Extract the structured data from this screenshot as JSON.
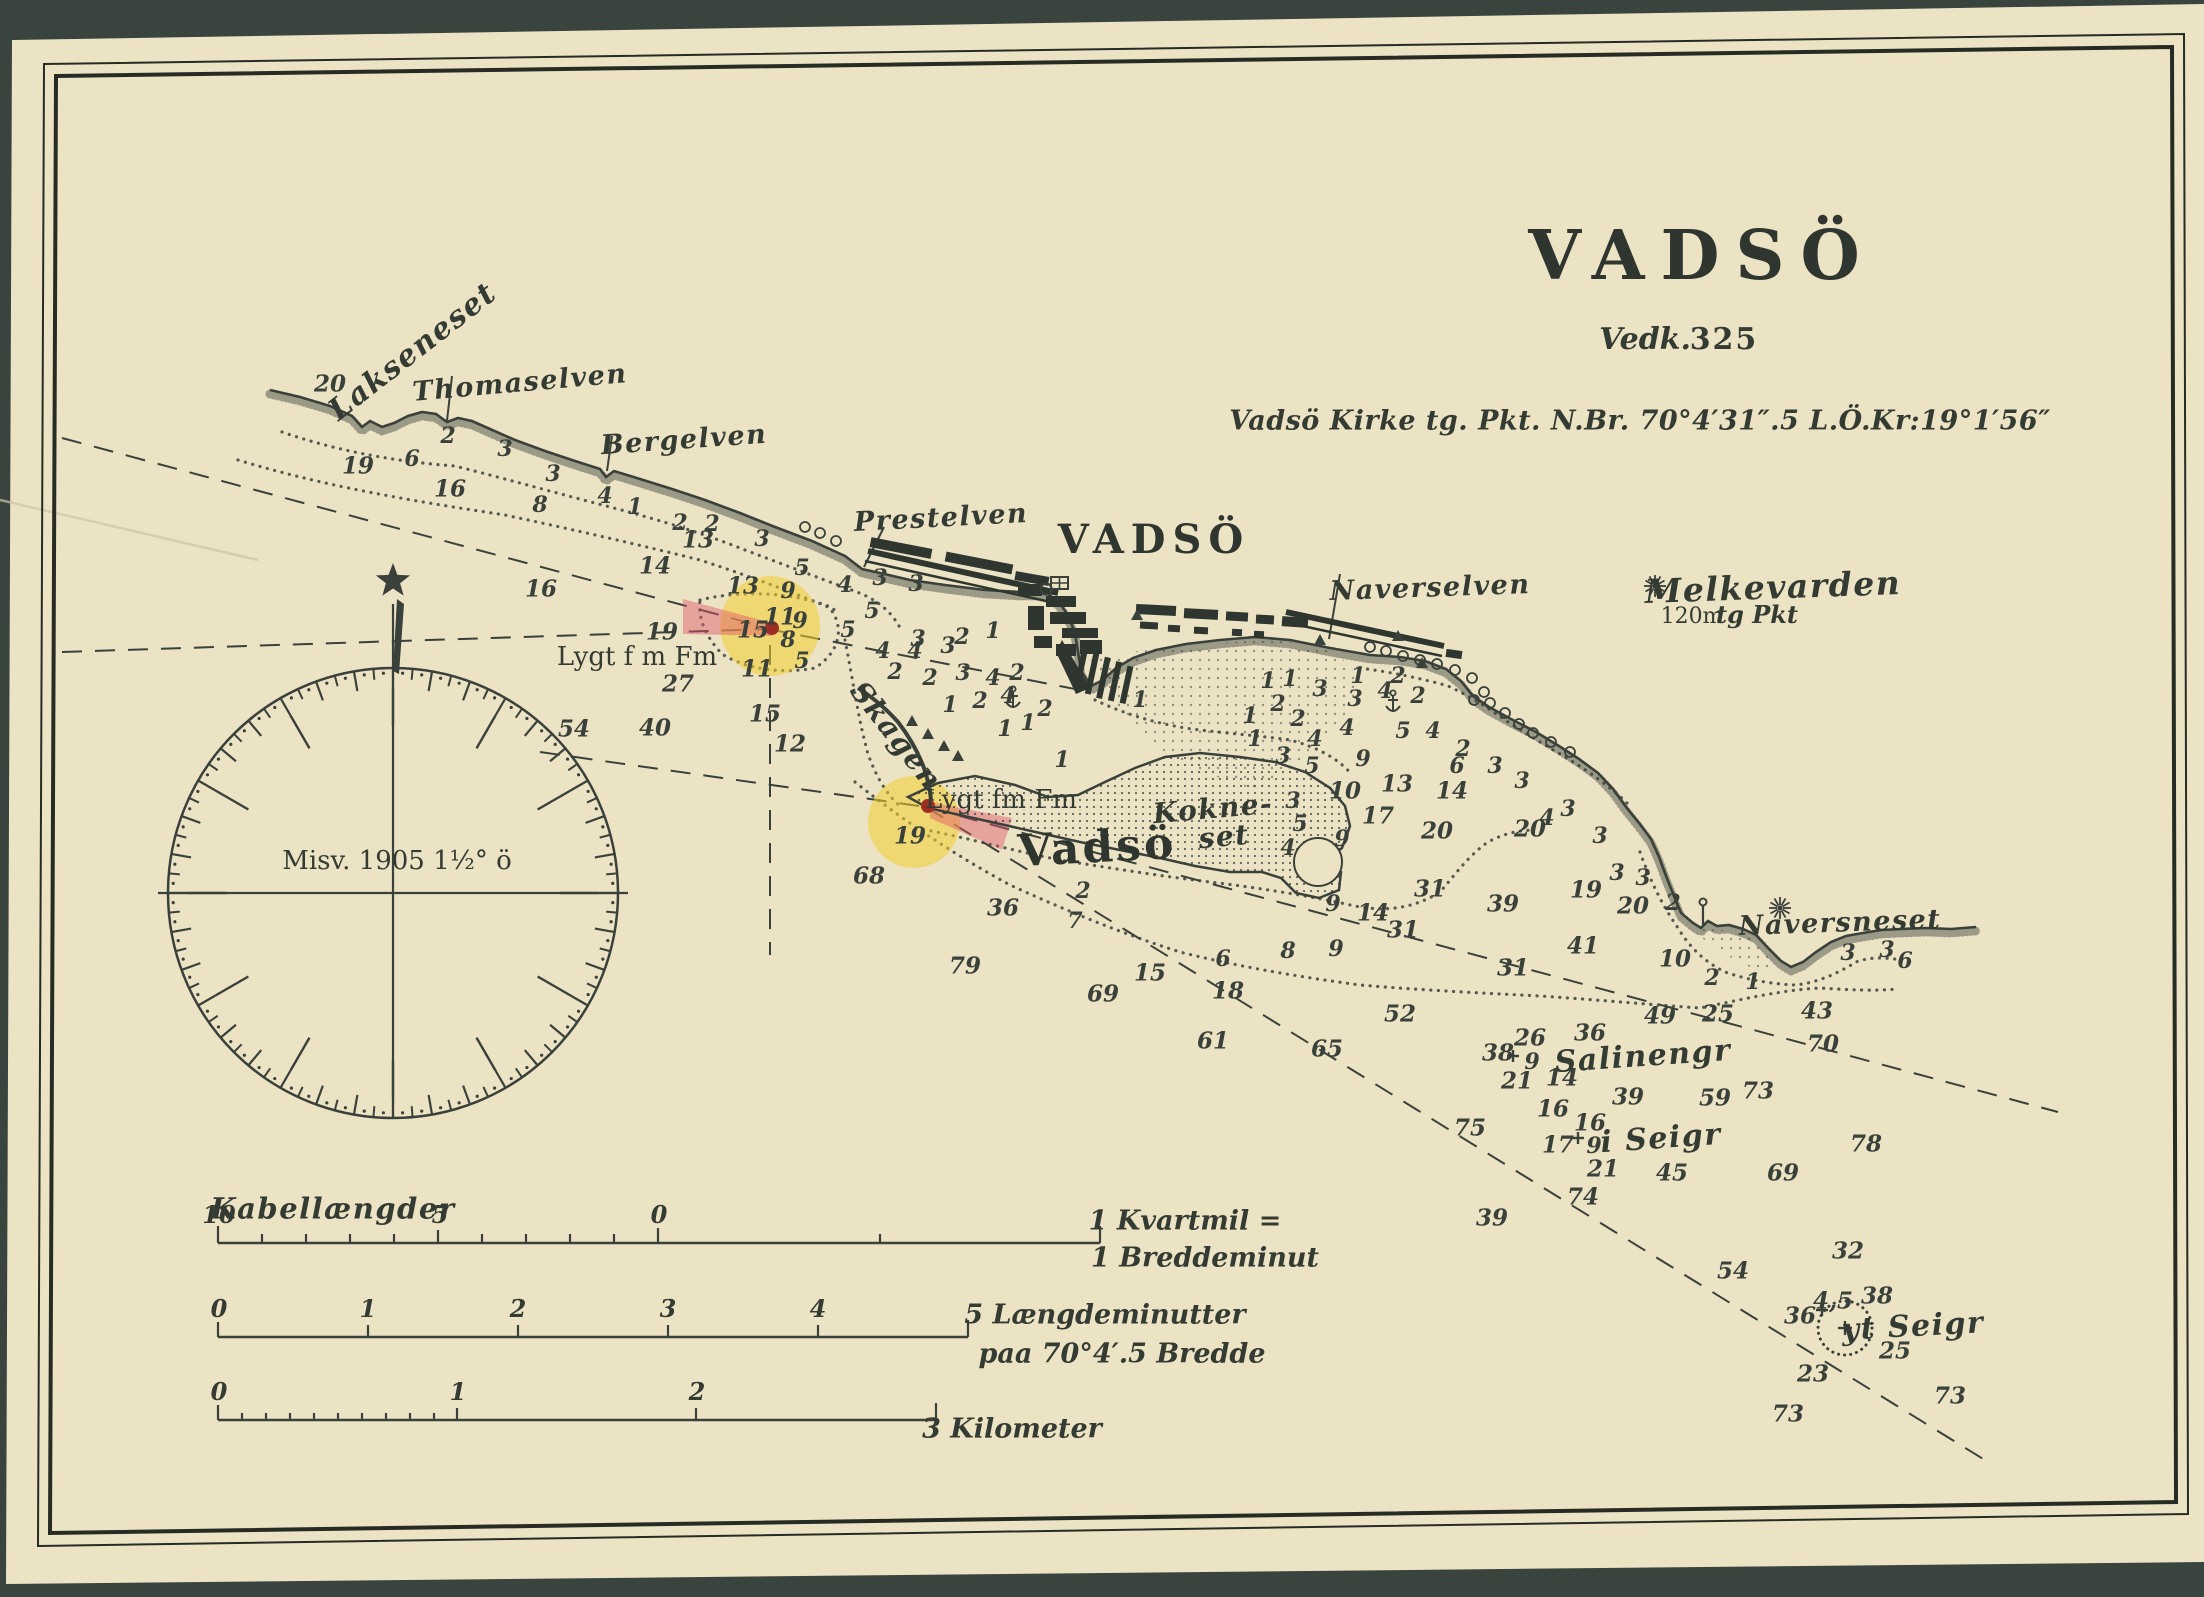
{
  "header": {
    "title": "VADSÖ",
    "vedk_label": "Vedk.",
    "vedk_number": "325",
    "position_line": "Vadsö Kirke tg. Pkt. N.Br. 70°4′31″.5 L.Ö.Kr:19°1′56″"
  },
  "compass": {
    "declination": "Misv. 1905 1½° ö"
  },
  "scales": {
    "bar1": {
      "name": "Kabellængder",
      "numbers": [
        {
          "t": "10",
          "x": 219
        },
        {
          "t": "5",
          "x": 440
        },
        {
          "t": "0",
          "x": 659
        }
      ],
      "right_label_1": "1 Kvartmil =",
      "right_label_2": "1 Breddeminut"
    },
    "bar2": {
      "numbers": [
        {
          "t": "0",
          "x": 219
        },
        {
          "t": "1",
          "x": 368
        },
        {
          "t": "2",
          "x": 518
        },
        {
          "t": "3",
          "x": 668
        },
        {
          "t": "4",
          "x": 818
        }
      ],
      "right_label_1": "5 Længdeminutter",
      "right_label_2": "paa 70°4′.5 Bredde"
    },
    "bar3": {
      "numbers": [
        {
          "t": "0",
          "x": 219
        },
        {
          "t": "1",
          "x": 458
        },
        {
          "t": "2",
          "x": 697
        }
      ],
      "right_label_1": "3 Kilometer",
      "right_label_2": ""
    }
  },
  "labels": [
    {
      "t": "Lakseneset",
      "x": 413,
      "y": 352,
      "s": 30,
      "r": -38,
      "c": "script"
    },
    {
      "t": "Thomaselven",
      "x": 520,
      "y": 383,
      "s": 27,
      "r": -5,
      "c": "script"
    },
    {
      "t": "Bergelven",
      "x": 684,
      "y": 440,
      "s": 27,
      "r": -4,
      "c": "script"
    },
    {
      "t": "Prestelven",
      "x": 941,
      "y": 518,
      "s": 27,
      "r": -3,
      "c": "script"
    },
    {
      "t": "VADSÖ",
      "x": 1154,
      "y": 540,
      "s": 40,
      "ls": 7,
      "c": "town"
    },
    {
      "t": "Naverselven",
      "x": 1430,
      "y": 588,
      "s": 27,
      "r": -2,
      "c": "script"
    },
    {
      "t": "Melkevarden",
      "x": 1773,
      "y": 587,
      "s": 33,
      "r": -2,
      "c": "script"
    },
    {
      "t": "120m",
      "x": 1692,
      "y": 617,
      "s": 22,
      "c": "plain"
    },
    {
      "t": "tg Pkt",
      "x": 1757,
      "y": 615,
      "s": 24,
      "c": "scalelbl"
    },
    {
      "t": "Skagen",
      "x": 896,
      "y": 736,
      "s": 29,
      "r": 52,
      "c": "script"
    },
    {
      "t": "Lygt f m Fm",
      "x": 637,
      "y": 657,
      "s": 26,
      "c": "plain"
    },
    {
      "t": "Lygt fm Fm",
      "x": 1001,
      "y": 800,
      "s": 26,
      "c": "plain"
    },
    {
      "t": "Vadsö",
      "x": 1097,
      "y": 848,
      "s": 44,
      "ls": 3,
      "r": -3,
      "c": "town"
    },
    {
      "t": "Kokne-",
      "x": 1213,
      "y": 809,
      "s": 28,
      "r": -5,
      "c": "script"
    },
    {
      "t": "set",
      "x": 1224,
      "y": 837,
      "s": 28,
      "r": -5,
      "c": "script"
    },
    {
      "t": "Naversneset",
      "x": 1840,
      "y": 923,
      "s": 27,
      "r": -2,
      "c": "script"
    },
    {
      "t": "Salinengr",
      "x": 1643,
      "y": 1057,
      "s": 30,
      "r": -4,
      "c": "script"
    },
    {
      "t": "i Seigr",
      "x": 1661,
      "y": 1139,
      "s": 30,
      "r": -4,
      "c": "script"
    },
    {
      "t": "yt Seigr",
      "x": 1913,
      "y": 1327,
      "s": 30,
      "r": -3,
      "c": "script"
    },
    {
      "t": "Kabellængder",
      "x": 333,
      "y": 1209,
      "s": 29,
      "c": "script"
    }
  ],
  "soundings": [
    [
      330,
      384,
      "20"
    ],
    [
      358,
      466,
      "19"
    ],
    [
      412,
      459,
      "6"
    ],
    [
      448,
      436,
      "2"
    ],
    [
      505,
      449,
      "3"
    ],
    [
      450,
      489,
      "16"
    ],
    [
      553,
      474,
      "3"
    ],
    [
      540,
      505,
      "8"
    ],
    [
      605,
      496,
      "4"
    ],
    [
      635,
      507,
      "1"
    ],
    [
      680,
      523,
      "2"
    ],
    [
      712,
      524,
      "2"
    ],
    [
      698,
      540,
      "13"
    ],
    [
      762,
      539,
      "3"
    ],
    [
      655,
      566,
      "14"
    ],
    [
      541,
      589,
      "16"
    ],
    [
      743,
      586,
      "13"
    ],
    [
      802,
      568,
      "5"
    ],
    [
      788,
      591,
      "9"
    ],
    [
      845,
      585,
      "4"
    ],
    [
      880,
      578,
      "3"
    ],
    [
      916,
      584,
      "3"
    ],
    [
      848,
      630,
      "5"
    ],
    [
      872,
      611,
      "5"
    ],
    [
      780,
      617,
      "11"
    ],
    [
      800,
      621,
      "9"
    ],
    [
      753,
      630,
      "15"
    ],
    [
      788,
      640,
      "8"
    ],
    [
      662,
      632,
      "19"
    ],
    [
      678,
      684,
      "27"
    ],
    [
      757,
      669,
      "11"
    ],
    [
      802,
      661,
      "5"
    ],
    [
      883,
      651,
      "4"
    ],
    [
      915,
      651,
      "4"
    ],
    [
      948,
      646,
      "3"
    ],
    [
      918,
      639,
      "3"
    ],
    [
      962,
      637,
      "2"
    ],
    [
      993,
      631,
      "1"
    ],
    [
      930,
      678,
      "2"
    ],
    [
      963,
      673,
      "3"
    ],
    [
      993,
      678,
      "4"
    ],
    [
      1017,
      673,
      "2"
    ],
    [
      895,
      672,
      "2"
    ],
    [
      950,
      705,
      "1"
    ],
    [
      980,
      701,
      "2"
    ],
    [
      1008,
      696,
      "4"
    ],
    [
      1045,
      709,
      "2"
    ],
    [
      1005,
      729,
      "1"
    ],
    [
      1028,
      723,
      "1"
    ],
    [
      1062,
      760,
      "1"
    ],
    [
      1140,
      700,
      "1"
    ],
    [
      765,
      714,
      "15"
    ],
    [
      790,
      744,
      "12"
    ],
    [
      655,
      728,
      "40"
    ],
    [
      574,
      729,
      "54"
    ],
    [
      910,
      836,
      "19"
    ],
    [
      869,
      876,
      "68"
    ],
    [
      1003,
      908,
      "36"
    ],
    [
      1083,
      891,
      "2"
    ],
    [
      1075,
      921,
      "7"
    ],
    [
      965,
      966,
      "79"
    ],
    [
      1150,
      973,
      "15"
    ],
    [
      1103,
      994,
      "69"
    ],
    [
      1223,
      959,
      "6"
    ],
    [
      1288,
      951,
      "8"
    ],
    [
      1336,
      949,
      "9"
    ],
    [
      1373,
      913,
      "14"
    ],
    [
      1403,
      930,
      "31"
    ],
    [
      1513,
      968,
      "31"
    ],
    [
      1583,
      946,
      "41"
    ],
    [
      1228,
      991,
      "18"
    ],
    [
      1213,
      1041,
      "61"
    ],
    [
      1327,
      1049,
      "65"
    ],
    [
      1400,
      1014,
      "52"
    ],
    [
      1470,
      1128,
      "75"
    ],
    [
      1268,
      681,
      "1"
    ],
    [
      1290,
      679,
      "1"
    ],
    [
      1320,
      689,
      "3"
    ],
    [
      1355,
      699,
      "3"
    ],
    [
      1358,
      676,
      "1"
    ],
    [
      1385,
      691,
      "4"
    ],
    [
      1398,
      676,
      "2"
    ],
    [
      1418,
      696,
      "2"
    ],
    [
      1278,
      704,
      "2"
    ],
    [
      1250,
      716,
      "1"
    ],
    [
      1298,
      719,
      "2"
    ],
    [
      1255,
      739,
      "1"
    ],
    [
      1283,
      756,
      "3"
    ],
    [
      1315,
      739,
      "4"
    ],
    [
      1347,
      728,
      "4"
    ],
    [
      1312,
      766,
      "5"
    ],
    [
      1403,
      731,
      "5"
    ],
    [
      1433,
      731,
      "4"
    ],
    [
      1363,
      759,
      "9"
    ],
    [
      1463,
      749,
      "2"
    ],
    [
      1457,
      766,
      "6"
    ],
    [
      1495,
      766,
      "3"
    ],
    [
      1522,
      781,
      "3"
    ],
    [
      1345,
      791,
      "10"
    ],
    [
      1397,
      784,
      "13"
    ],
    [
      1452,
      791,
      "14"
    ],
    [
      1378,
      816,
      "17"
    ],
    [
      1437,
      831,
      "20"
    ],
    [
      1530,
      829,
      "20"
    ],
    [
      1547,
      818,
      "4"
    ],
    [
      1342,
      839,
      "9"
    ],
    [
      1293,
      801,
      "3"
    ],
    [
      1300,
      824,
      "5"
    ],
    [
      1288,
      848,
      "4"
    ],
    [
      1430,
      889,
      "31"
    ],
    [
      1503,
      904,
      "39"
    ],
    [
      1333,
      904,
      "9"
    ],
    [
      1568,
      809,
      "3"
    ],
    [
      1600,
      836,
      "3"
    ],
    [
      1586,
      890,
      "19"
    ],
    [
      1617,
      873,
      "3"
    ],
    [
      1643,
      878,
      "3"
    ],
    [
      1633,
      906,
      "20"
    ],
    [
      1675,
      959,
      "10"
    ],
    [
      1673,
      903,
      "2"
    ],
    [
      1712,
      978,
      "2"
    ],
    [
      1753,
      982,
      "1"
    ],
    [
      1848,
      953,
      "3"
    ],
    [
      1887,
      950,
      "3"
    ],
    [
      1905,
      961,
      "6"
    ],
    [
      1660,
      1016,
      "49"
    ],
    [
      1718,
      1014,
      "25"
    ],
    [
      1817,
      1011,
      "43"
    ],
    [
      1823,
      1044,
      "70"
    ],
    [
      1530,
      1038,
      "26"
    ],
    [
      1498,
      1053,
      "38"
    ],
    [
      1532,
      1062,
      "9"
    ],
    [
      1517,
      1081,
      "21"
    ],
    [
      1562,
      1078,
      "14"
    ],
    [
      1590,
      1033,
      "36"
    ],
    [
      1628,
      1097,
      "39"
    ],
    [
      1715,
      1098,
      "59"
    ],
    [
      1758,
      1091,
      "73"
    ],
    [
      1553,
      1109,
      "16"
    ],
    [
      1590,
      1123,
      "16"
    ],
    [
      1558,
      1145,
      "17"
    ],
    [
      1594,
      1146,
      "9"
    ],
    [
      1603,
      1169,
      "21"
    ],
    [
      1672,
      1173,
      "45"
    ],
    [
      1783,
      1173,
      "69"
    ],
    [
      1866,
      1144,
      "78"
    ],
    [
      1583,
      1197,
      "74"
    ],
    [
      1492,
      1218,
      "39"
    ],
    [
      1733,
      1271,
      "54"
    ],
    [
      1848,
      1251,
      "32"
    ],
    [
      1877,
      1296,
      "38"
    ],
    [
      1833,
      1301,
      "4,5"
    ],
    [
      1800,
      1316,
      "36"
    ],
    [
      1895,
      1351,
      "25"
    ],
    [
      1813,
      1374,
      "23"
    ],
    [
      1950,
      1396,
      "73"
    ],
    [
      1788,
      1414,
      "73"
    ]
  ],
  "symbols": {
    "cairn_stars": [
      [
        1655,
        586
      ],
      [
        1780,
        908
      ]
    ],
    "anchors": [
      [
        1013,
        700
      ],
      [
        1393,
        704
      ]
    ],
    "church": [
      1046,
      589
    ],
    "plus_rocks": [
      [
        1513,
        1056
      ],
      [
        1578,
        1138
      ],
      [
        1822,
        1310
      ]
    ],
    "danger_circle": [
      1845,
      1328
    ],
    "beacon_triangles": [
      [
        1137,
        616
      ],
      [
        1320,
        641
      ],
      [
        1398,
        637
      ],
      [
        1422,
        664
      ],
      [
        928,
        735
      ],
      [
        944,
        747
      ],
      [
        958,
        757
      ],
      [
        912,
        722
      ]
    ],
    "rocks": [
      [
        805,
        527
      ],
      [
        820,
        533
      ],
      [
        836,
        541
      ],
      [
        1370,
        647
      ],
      [
        1386,
        651
      ],
      [
        1403,
        656
      ],
      [
        1420,
        660
      ],
      [
        1437,
        664
      ],
      [
        1455,
        670
      ],
      [
        1472,
        678
      ],
      [
        1484,
        692
      ],
      [
        1474,
        700
      ],
      [
        1490,
        703
      ],
      [
        1505,
        713
      ],
      [
        1519,
        724
      ],
      [
        1533,
        733
      ],
      [
        1551,
        742
      ],
      [
        1570,
        752
      ]
    ],
    "lights": [
      [
        772,
        628
      ],
      [
        928,
        806
      ]
    ],
    "flagpole": [
      1703,
      925
    ]
  },
  "colors": {
    "paper": "#ece3c5",
    "ink": "#39413a",
    "frame": "#262b23",
    "light_halo": "#f2cd2e",
    "light_sector": "#e0556a",
    "light_dot": "#9c2f23"
  }
}
